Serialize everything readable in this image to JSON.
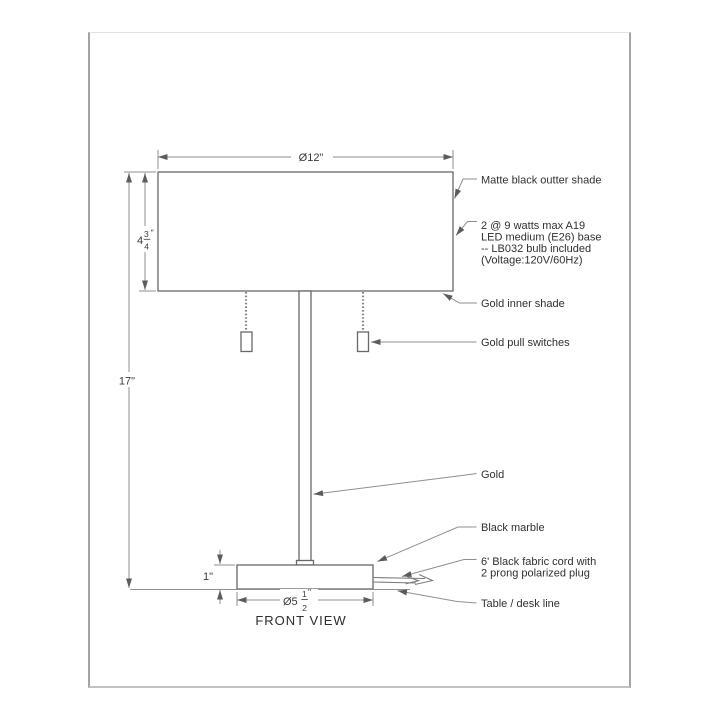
{
  "drawing": {
    "view_label": "FRONT VIEW",
    "dimensions": {
      "shade_diameter": "Ø12\"",
      "total_height": "17\"",
      "base_height": "1\"",
      "shade_height": {
        "whole": "4",
        "num": "3",
        "den": "4",
        "unit": "\""
      },
      "base_diameter": {
        "prefix": "Ø5",
        "num": "1",
        "den": "2",
        "unit": "\""
      }
    },
    "annotations": {
      "outer_shade": "Matte black outter shade",
      "bulb_line1": "2 @ 9 watts max A19",
      "bulb_line2": "LED medium (E26) base",
      "bulb_line3": "-- LB032 bulb included",
      "bulb_line4": "(Voltage:120V/60Hz)",
      "inner_shade": "Gold inner shade",
      "pull_switches": "Gold pull switches",
      "stem": "Gold",
      "base": "Black marble",
      "cord_line1": "6' Black fabric cord with",
      "cord_line2": "2 prong polarized plug",
      "table_line": "Table / desk line"
    },
    "colors": {
      "line": "#686868",
      "dim_line": "#8f8f8f",
      "text": "#303030",
      "frame_border": "#a6a6a6",
      "background": "#ffffff"
    }
  }
}
